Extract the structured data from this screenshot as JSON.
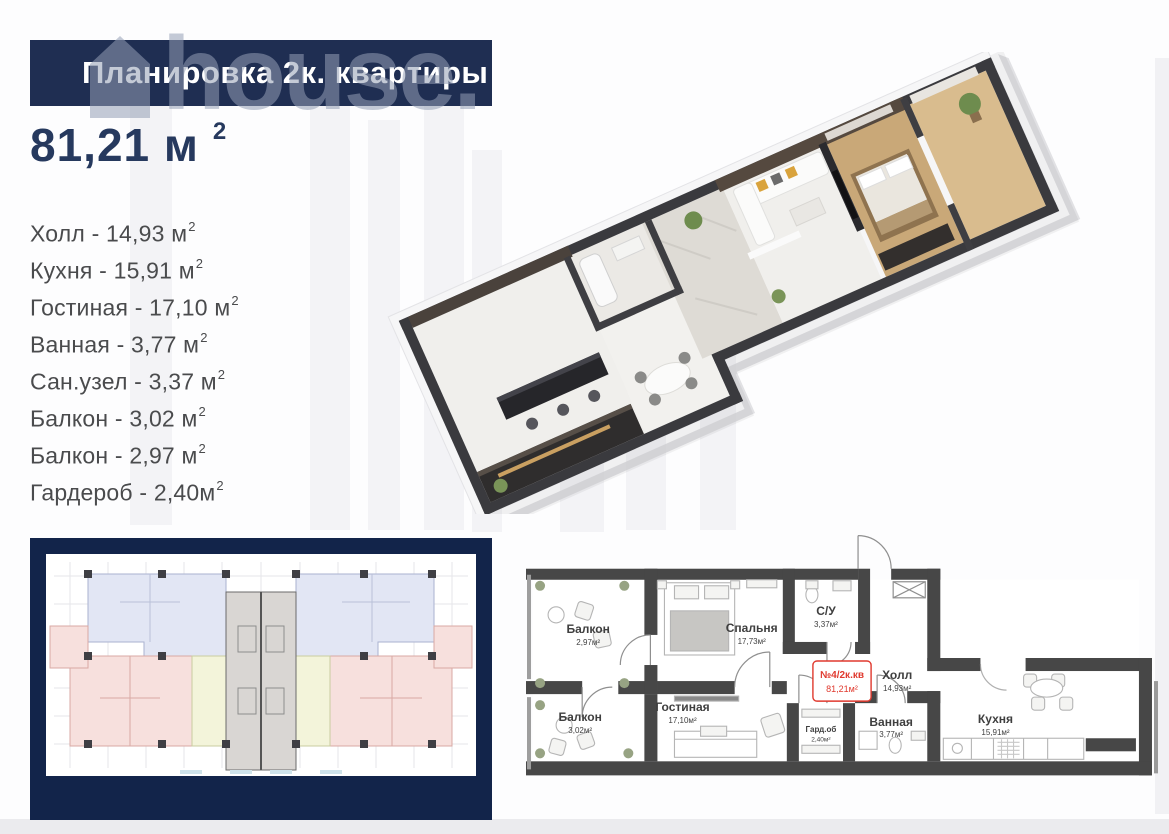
{
  "banner": {
    "title": "Планировка 2к. квартиры"
  },
  "watermark": {
    "text": "house."
  },
  "area_title": {
    "value": "81,21 м",
    "sup": "2"
  },
  "room_list": [
    {
      "label": "Холл - 14,93 м",
      "sup": "2"
    },
    {
      "label": "Кухня - 15,91 м",
      "sup": "2"
    },
    {
      "label": "Гостиная - 17,10 м",
      "sup": "2"
    },
    {
      "label": "Ванная - 3,77 м",
      "sup": "2"
    },
    {
      "label": "Сан.узел - 3,37 м",
      "sup": "2"
    },
    {
      "label": "Балкон - 3,02 м",
      "sup": "2"
    },
    {
      "label": "Балкон - 2,97 м",
      "sup": "2"
    },
    {
      "label": "Гардероб - 2,40м",
      "sup": "2"
    }
  ],
  "plan2d": {
    "rooms": {
      "balcony_top": {
        "name": "Балкон",
        "area": "2,97м²"
      },
      "bedroom": {
        "name": "Спальня",
        "area": "17,73м²"
      },
      "wc": {
        "name": "С/У",
        "area": "3,37м²"
      },
      "hall": {
        "name": "Холл",
        "area": "14,93м²"
      },
      "balcony_bottom": {
        "name": "Балкон",
        "area": "3,02м²"
      },
      "living": {
        "name": "Гостиная",
        "area": "17,10м²"
      },
      "wardrobe": {
        "name": "Гард.об",
        "area": "2,40м²"
      },
      "bath": {
        "name": "Ванная",
        "area": "3,77м²"
      },
      "kitchen": {
        "name": "Кухня",
        "area": "15,91м²"
      }
    },
    "unit_label": {
      "line1": "№4/2к.кв",
      "line2": "81,21м²"
    }
  },
  "colors": {
    "banner_navy": "#1f2e52",
    "frame_navy": "#12244a",
    "title_navy": "#26395e",
    "list_text": "#4a4b4d",
    "plan_wall_gray": "#474747",
    "accent_red": "#e0392e",
    "plan_blue": "#e2e6f4",
    "plan_pink": "#f7e0dd",
    "plan_yellow": "#f3f4da",
    "plan_core_gray": "#d9d6d3"
  }
}
